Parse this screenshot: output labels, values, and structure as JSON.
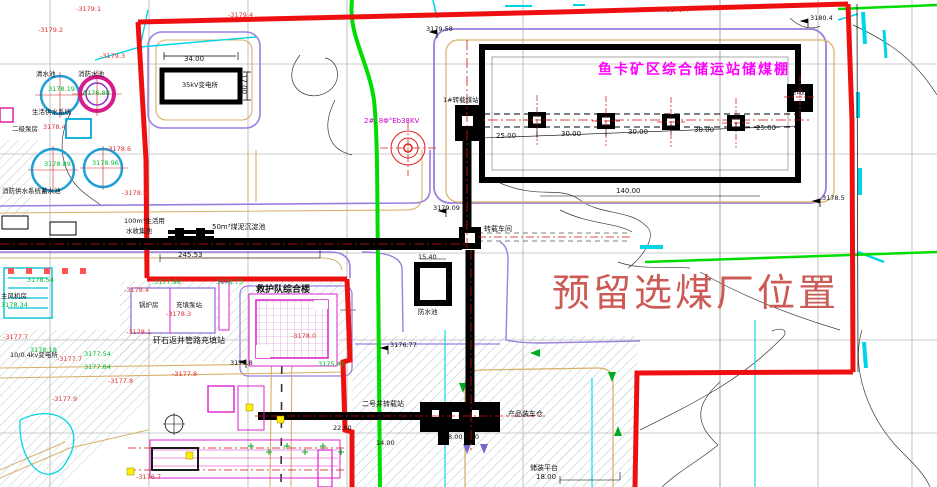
{
  "drawing": {
    "type": "CAD site plan",
    "title_shed": "鱼卡矿区综合储运站储煤棚",
    "reserved_area": "预留选煤厂位置"
  },
  "palette": {
    "boundary_red": "#ee1010",
    "title_magenta": "#ff00ff",
    "reserved_pink": "#cc5a55",
    "pipeline_green": "#00dd00",
    "road_purple": "#9b7fe0",
    "road_tan": "#d8b06a",
    "water_cyan": "#00d5e8",
    "elev_red": "#e03030",
    "elev_green": "#00bb33"
  },
  "labels": [
    {
      "name": "shed-title",
      "text": "鱼卡矿区综合储运站储煤棚",
      "x": 598,
      "y": 63,
      "color": "#ff00ff",
      "size": 14,
      "bold": true,
      "ls": 2
    },
    {
      "name": "reserved-area-text",
      "text": "预留选煤厂位置",
      "x": 552,
      "y": 274,
      "color": "#cc5a55",
      "size": 38,
      "bold": false,
      "ls": 3
    },
    {
      "name": "substation-35kv",
      "text": "35kV变电所",
      "x": 182,
      "y": 82,
      "color": "#111111",
      "size": 6.5
    },
    {
      "name": "clear-water-pool",
      "text": "清水池",
      "x": 36,
      "y": 71,
      "color": "#111111",
      "size": 6.5
    },
    {
      "name": "fire-water-pool",
      "text": "消防水池",
      "x": 78,
      "y": 71,
      "color": "#111111",
      "size": 6.5
    },
    {
      "name": "domestic-water-system",
      "text": "生活供水系统",
      "x": 32,
      "y": 109,
      "color": "#111111",
      "size": 6.5
    },
    {
      "name": "secondary-pump-house",
      "text": "二级泵房",
      "x": 12,
      "y": 126,
      "color": "#111111",
      "size": 6.5
    },
    {
      "name": "fire-water-reservoir",
      "text": "消防供水系统蓄水池",
      "x": 2,
      "y": 188,
      "color": "#111111",
      "size": 6.5
    },
    {
      "name": "main-fan-house",
      "text": "主风机房",
      "x": 1,
      "y": 293,
      "color": "#111111",
      "size": 6.5
    },
    {
      "name": "rescue-team-building",
      "text": "救护队综合楼",
      "x": 256,
      "y": 286,
      "color": "#111111",
      "size": 9,
      "bold": true
    },
    {
      "name": "gangue-backfill-station",
      "text": "矸石返井管路充填站",
      "x": 153,
      "y": 337,
      "color": "#111111",
      "size": 8
    },
    {
      "name": "boiler-house",
      "text": "锅炉房",
      "x": 139,
      "y": 302,
      "color": "#111111",
      "size": 6.5
    },
    {
      "name": "backfill-pump-station",
      "text": "充填泵站",
      "x": 176,
      "y": 302,
      "color": "#111111",
      "size": 6.5
    },
    {
      "name": "substation-10kv",
      "text": "10/0.4kv变电所",
      "x": 10,
      "y": 352,
      "color": "#111111",
      "size": 6.5
    },
    {
      "name": "transfer-workshop",
      "text": "转载车间",
      "x": 484,
      "y": 226,
      "color": "#111111",
      "size": 7
    },
    {
      "name": "transfer-station-1",
      "text": "1#转载煤站",
      "x": 443,
      "y": 97,
      "color": "#111111",
      "size": 6.5
    },
    {
      "name": "drive-room",
      "text": "驱动间",
      "x": 790,
      "y": 89,
      "color": "#111111",
      "size": 6.5
    },
    {
      "name": "shaft2-transfer-station",
      "text": "二号井转载站",
      "x": 362,
      "y": 401,
      "color": "#111111",
      "size": 7
    },
    {
      "name": "product-loading-bin",
      "text": "产品装车仓",
      "x": 508,
      "y": 411,
      "color": "#111111",
      "size": 7
    },
    {
      "name": "loading-platform",
      "text": "储装平台",
      "x": 530,
      "y": 465,
      "color": "#111111",
      "size": 7
    },
    {
      "name": "fire-pool-400-line1",
      "text": "400m³消",
      "x": 416,
      "y": 300,
      "color": "#111111",
      "size": 6.5
    },
    {
      "name": "fire-pool-400-line2",
      "text": "防水池",
      "x": 418,
      "y": 309,
      "color": "#111111",
      "size": 6.5
    },
    {
      "name": "slurry-pond-50",
      "text": "50m³煤泥沉淀池",
      "x": 212,
      "y": 224,
      "color": "#111111",
      "size": 7
    },
    {
      "name": "collect-pool-line1",
      "text": "100m³生活用",
      "x": 124,
      "y": 218,
      "color": "#111111",
      "size": 6.5
    },
    {
      "name": "collect-pool-line2",
      "text": "水收集池",
      "x": 126,
      "y": 228,
      "color": "#111111",
      "size": 6.5
    },
    {
      "name": "borehole-label",
      "text": "2#, 8Φ°Eb38KV",
      "x": 364,
      "y": 118,
      "color": "#cc00cc",
      "size": 7
    },
    {
      "name": "dim-34",
      "text": "34.00",
      "x": 184,
      "y": 56,
      "color": "#111111",
      "size": 7
    },
    {
      "name": "dim-17",
      "text": "17.00",
      "x": 247,
      "y": 74,
      "color": "#111111",
      "size": 7,
      "rot": 90
    },
    {
      "name": "dim-25a",
      "text": "25.00",
      "x": 496,
      "y": 133,
      "color": "#111111",
      "size": 7
    },
    {
      "name": "dim-30a",
      "text": "30.00",
      "x": 561,
      "y": 131,
      "color": "#111111",
      "size": 7
    },
    {
      "name": "dim-30b",
      "text": "30.00",
      "x": 628,
      "y": 129,
      "color": "#111111",
      "size": 7
    },
    {
      "name": "dim-30c",
      "text": "30.00",
      "x": 694,
      "y": 127,
      "color": "#111111",
      "size": 7
    },
    {
      "name": "dim-25b",
      "text": "25.00",
      "x": 756,
      "y": 125,
      "color": "#111111",
      "size": 7
    },
    {
      "name": "dim-140",
      "text": "140.00",
      "x": 616,
      "y": 188,
      "color": "#111111",
      "size": 7
    },
    {
      "name": "dim-245",
      "text": "245.53",
      "x": 178,
      "y": 252,
      "color": "#111111",
      "size": 7
    },
    {
      "name": "dim-15-40",
      "text": "15.40",
      "x": 418,
      "y": 254,
      "color": "#111111",
      "size": 6.5
    },
    {
      "name": "dim-11-40",
      "text": "11.40",
      "x": 452,
      "y": 266,
      "color": "#111111",
      "size": 6.5,
      "rot": 90
    },
    {
      "name": "dim-22-60",
      "text": "22.60",
      "x": 333,
      "y": 425,
      "color": "#111111",
      "size": 6.5
    },
    {
      "name": "dim-14",
      "text": "14.00",
      "x": 376,
      "y": 440,
      "color": "#111111",
      "size": 6.5
    },
    {
      "name": "dim-8-8",
      "text": "8.00 8.00",
      "x": 448,
      "y": 434,
      "color": "#111111",
      "size": 6.5
    },
    {
      "name": "dim-18",
      "text": "18.00",
      "x": 536,
      "y": 474,
      "color": "#111111",
      "size": 7
    },
    {
      "name": "spot-3179-58",
      "text": "3179.58",
      "x": 426,
      "y": 26,
      "color": "#111111",
      "size": 6.5
    },
    {
      "name": "spot-3179-09",
      "text": "3179.09",
      "x": 433,
      "y": 205,
      "color": "#111111",
      "size": 6.5
    },
    {
      "name": "spot-3180-4",
      "text": "3180.4",
      "x": 810,
      "y": 15,
      "color": "#111111",
      "size": 6.5
    },
    {
      "name": "spot-3178-5",
      "text": "3178.5",
      "x": 822,
      "y": 195,
      "color": "#111111",
      "size": 6.5
    },
    {
      "name": "spot-3176-77",
      "text": "3176.77",
      "x": 390,
      "y": 342,
      "color": "#111111",
      "size": 6.5
    },
    {
      "name": "spot-3177-8f",
      "text": "3177.8",
      "x": 230,
      "y": 360,
      "color": "#111111",
      "size": 6.5
    },
    {
      "name": "elev-r1",
      "text": "-3179.1",
      "x": 76,
      "y": 6,
      "color": "#e03030",
      "size": 6.5
    },
    {
      "name": "elev-r2",
      "text": "-3179.2",
      "x": 38,
      "y": 27,
      "color": "#e03030",
      "size": 6.5
    },
    {
      "name": "elev-r3",
      "text": "-3179.3",
      "x": 100,
      "y": 53,
      "color": "#e03030",
      "size": 6.5
    },
    {
      "name": "elev-r4",
      "text": "-3179.4",
      "x": 228,
      "y": 12,
      "color": "#e03030",
      "size": 6.5
    },
    {
      "name": "elev-r5",
      "text": "-3179.4",
      "x": 664,
      "y": 7,
      "color": "#e03030",
      "size": 6.5
    },
    {
      "name": "elev-r6",
      "text": "-3178.6",
      "x": 106,
      "y": 146,
      "color": "#e03030",
      "size": 6.5
    },
    {
      "name": "elev-r7",
      "text": "-3178.5",
      "x": 122,
      "y": 190,
      "color": "#e03030",
      "size": 6.5
    },
    {
      "name": "elev-r8",
      "text": "3178.4",
      "x": 43,
      "y": 124,
      "color": "#e03030",
      "size": 6.5
    },
    {
      "name": "elev-r9",
      "text": "-3178.4",
      "x": 124,
      "y": 287,
      "color": "#e03030",
      "size": 6.5
    },
    {
      "name": "elev-r10",
      "text": "-3178.3",
      "x": 166,
      "y": 311,
      "color": "#e03030",
      "size": 6.5
    },
    {
      "name": "elev-r11",
      "text": "-3178.1",
      "x": 126,
      "y": 329,
      "color": "#e03030",
      "size": 6.5
    },
    {
      "name": "elev-r12",
      "text": "-3178.0",
      "x": 291,
      "y": 333,
      "color": "#e03030",
      "size": 6.5
    },
    {
      "name": "elev-r13",
      "text": "-3177.7",
      "x": 3,
      "y": 334,
      "color": "#e03030",
      "size": 6.5
    },
    {
      "name": "elev-r14",
      "text": "-3177.7",
      "x": 57,
      "y": 356,
      "color": "#e03030",
      "size": 6.5
    },
    {
      "name": "elev-r15",
      "text": "-3177.8",
      "x": 172,
      "y": 371,
      "color": "#e03030",
      "size": 6.5
    },
    {
      "name": "elev-r16",
      "text": "-3177.9",
      "x": 52,
      "y": 396,
      "color": "#e03030",
      "size": 6.5
    },
    {
      "name": "elev-r17",
      "text": "-3176.7",
      "x": 136,
      "y": 474,
      "color": "#e03030",
      "size": 6.5
    },
    {
      "name": "elev-r18",
      "text": "-3177.8",
      "x": 108,
      "y": 378,
      "color": "#e03030",
      "size": 6.5
    },
    {
      "name": "elev-g1",
      "text": "3178.19",
      "x": 48,
      "y": 86,
      "color": "#00bb33",
      "size": 6.5
    },
    {
      "name": "elev-g2",
      "text": "3176.88",
      "x": 83,
      "y": 90,
      "color": "#00bb33",
      "size": 6.5
    },
    {
      "name": "elev-g3",
      "text": "3178.89",
      "x": 44,
      "y": 161,
      "color": "#00bb33",
      "size": 6.5
    },
    {
      "name": "elev-g4",
      "text": "3178.96",
      "x": 92,
      "y": 160,
      "color": "#00bb33",
      "size": 6.5
    },
    {
      "name": "elev-g5",
      "text": "3178.54",
      "x": 27,
      "y": 277,
      "color": "#00bb33",
      "size": 6.5
    },
    {
      "name": "elev-g6",
      "text": "3178.34",
      "x": 1,
      "y": 302,
      "color": "#00bb33",
      "size": 6.5
    },
    {
      "name": "elev-g7",
      "text": "3177.98",
      "x": 154,
      "y": 279,
      "color": "#00bb33",
      "size": 6.5
    },
    {
      "name": "elev-g8",
      "text": "3178.73",
      "x": 216,
      "y": 279,
      "color": "#00bb33",
      "size": 6.5
    },
    {
      "name": "elev-g9",
      "text": "3175.41",
      "x": 318,
      "y": 361,
      "color": "#00bb33",
      "size": 6.5
    },
    {
      "name": "elev-g10",
      "text": "3177.54",
      "x": 84,
      "y": 351,
      "color": "#00bb33",
      "size": 6.5
    },
    {
      "name": "elev-g11",
      "text": "3177.84",
      "x": 84,
      "y": 364,
      "color": "#00bb33",
      "size": 6.5
    },
    {
      "name": "elev-g12",
      "text": "3178.18",
      "x": 30,
      "y": 347,
      "color": "#00bb33",
      "size": 6.5
    }
  ]
}
